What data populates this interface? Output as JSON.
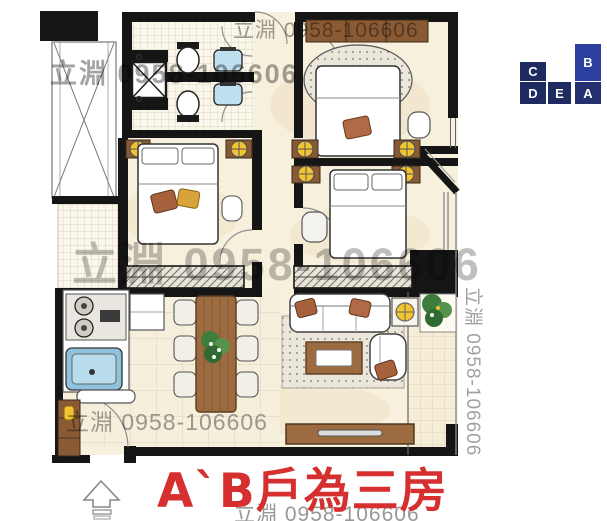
{
  "colors": {
    "watermark": "#8a8a8a",
    "caption_red": "#d62f2f",
    "unit_default": "#1e2b61",
    "unit_highlight": "#2c3f9f",
    "unit_alt": "#223070"
  },
  "watermarks": {
    "top": "立淵 0958-106606",
    "upper_left": "立淵 0958-106606",
    "center": "立淵 0958-106606",
    "lower_left": "立淵 0958-106606",
    "vertical_right": "立淵 0958-106606",
    "bottom_cut": "立淵 0958-106606"
  },
  "caption": {
    "text": "A`B戶為三房"
  },
  "unit_key": {
    "units": [
      {
        "label": "C"
      },
      {
        "label": "B"
      },
      {
        "label": "D"
      },
      {
        "label": "E"
      },
      {
        "label": "A"
      }
    ]
  }
}
